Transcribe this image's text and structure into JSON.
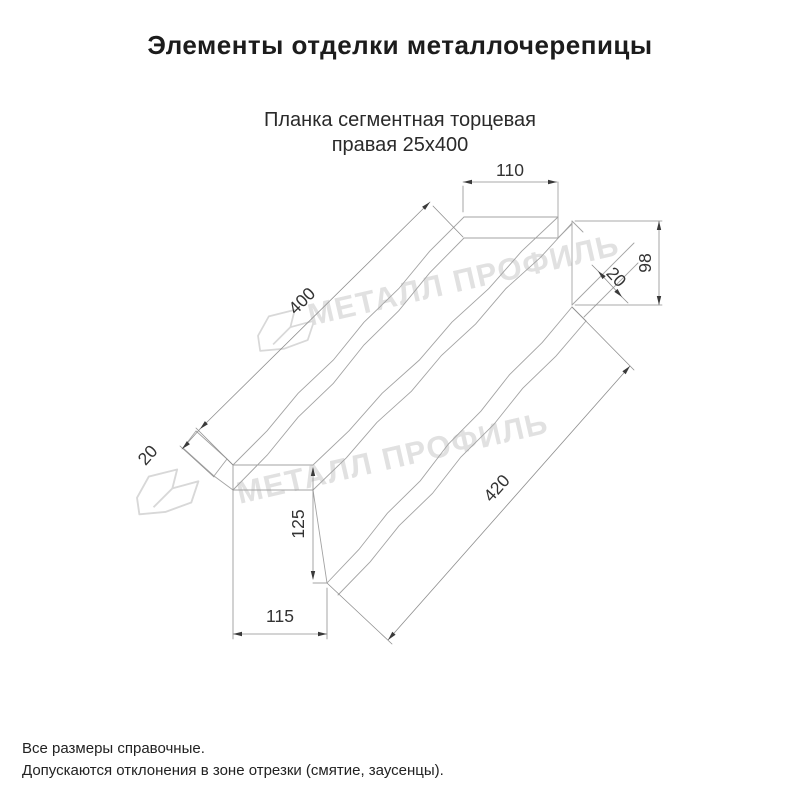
{
  "title": "Элементы отделки металлочерепицы",
  "subtitle": {
    "line1": "Планка сегментная торцевая",
    "line2": "правая 25х400"
  },
  "watermark": {
    "text": "МЕТАЛЛ ПРОФИЛЬ"
  },
  "dimensions": {
    "top_width": {
      "label": "110"
    },
    "right_height": {
      "label": "98"
    },
    "right_flange": {
      "label": "20"
    },
    "back_length": {
      "label": "400"
    },
    "left_flange": {
      "label": "20"
    },
    "front_length": {
      "label": "420"
    },
    "left_height": {
      "label": "125"
    },
    "left_width": {
      "label": "115"
    }
  },
  "footer": {
    "line1": "Все размеры справочные.",
    "line2": "Допускаются отклонения в зоне отрезки (смятие, заусенцы)."
  }
}
